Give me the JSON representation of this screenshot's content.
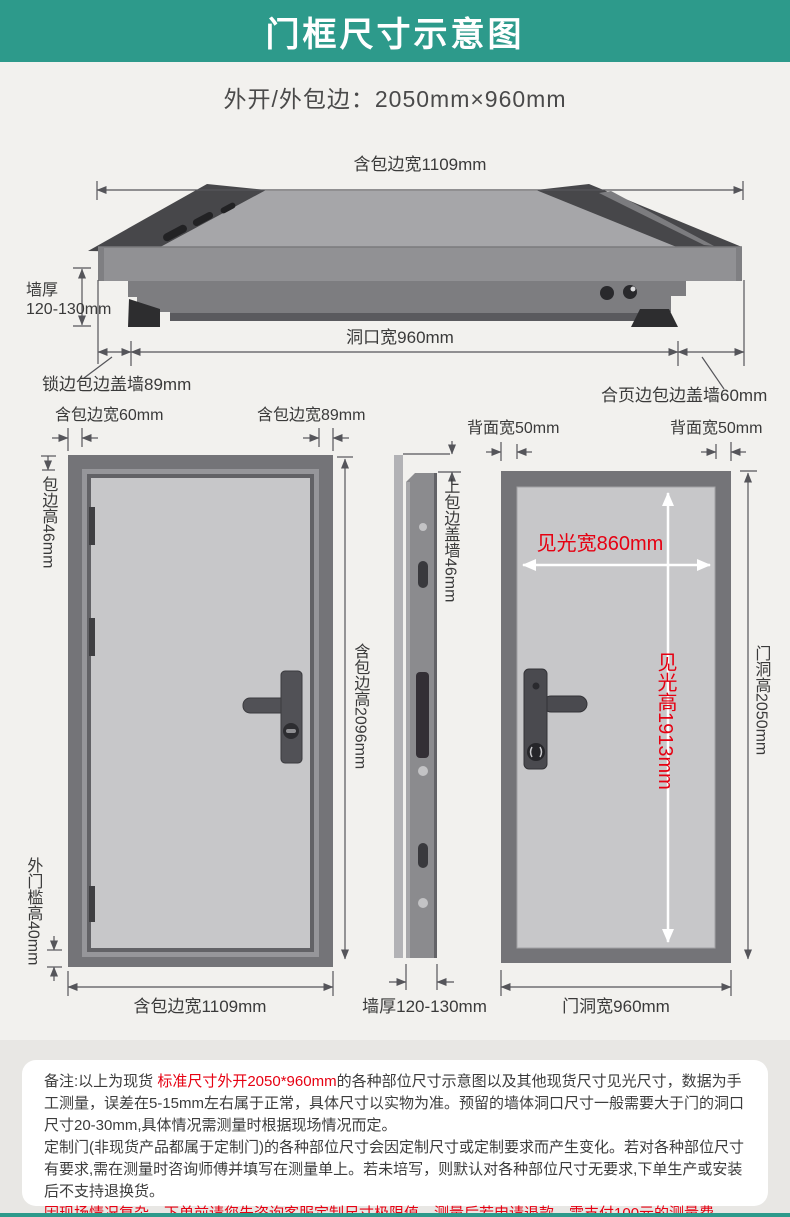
{
  "header": {
    "title": "门框尺寸示意图"
  },
  "subtitle": "外开/外包边：2050mm×960mm",
  "top_diagram": {
    "overall_width": "含包边宽1109mm",
    "wall_thickness_line1": "墙厚",
    "wall_thickness_line2": "120-130mm",
    "opening_width": "洞口宽960mm",
    "lock_side_cover": "锁边包边盖墙89mm",
    "hinge_side_cover": "合页边包边盖墙60mm"
  },
  "front_view": {
    "top_left_width": "含包边宽60mm",
    "top_right_width": "含包边宽89mm",
    "edge_height": "包边高46mm",
    "total_height": "含包边高2096mm",
    "threshold_height": "外门槛高40mm",
    "total_width": "含包边宽1109mm"
  },
  "side_view": {
    "top_cover": "上包边盖墙46mm",
    "wall_thickness": "墙厚120-130mm"
  },
  "back_view": {
    "back_width_left": "背面宽50mm",
    "back_width_right": "背面宽50mm",
    "visible_width": "见光宽860mm",
    "visible_height": "见光高1913mm",
    "hole_height": "门洞高2050mm",
    "hole_width": "门洞宽960mm"
  },
  "notes": {
    "p1": [
      {
        "text": "备注:以上为现货 ",
        "highlight": false
      },
      {
        "text": "标准尺寸外开2050*960mm",
        "highlight": true
      },
      {
        "text": "的各种部位尺寸示意图以及其他现货尺寸见光尺寸，数据为手工测量，误差在5-15mm左右属于正常，具体尺寸以实物为准。预留的墙体洞口尺寸一般需要大于门的洞口尺寸20-30mm,具体情况需测量时根据现场情况而定。",
        "highlight": false
      }
    ],
    "p2": [
      {
        "text": "定制门(非现货产品都属于定制门)的各种部位尺寸会因定制尺寸或定制要求而产生变化。若对各种部位尺寸有要求,需在测量时咨询师傅并填写在测量单上。若未培写，则默认对各种部位尺寸无要求,下单生产或安装后不支持退换货。",
        "highlight": false
      }
    ],
    "p3": [
      {
        "text": "因现场情况复杂，下单前请您先咨询客服定制尺寸极限值，测量后若申请退款，需支付100元的测量费。",
        "highlight": true
      }
    ]
  },
  "colors": {
    "header_teal": "#2d9a8b",
    "highlight_red": "#e60112",
    "frame_gray": "#747478",
    "panel_gray": "#c7c7c9",
    "dim_line": "#55555a",
    "page_bg": "#f2f1ee",
    "notes_bg": "#e8e7e4"
  }
}
